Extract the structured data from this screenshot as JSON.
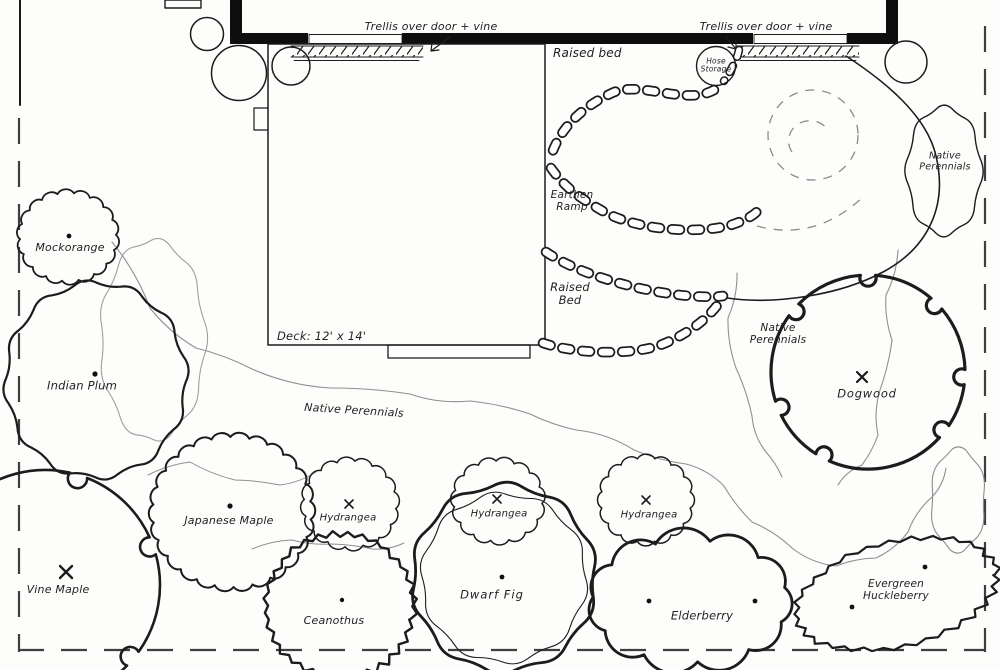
{
  "labels": {
    "trellis_left": "Trellis over door + vine",
    "trellis_right": "Trellis over door + vine",
    "raised_bed_upper": "Raised bed",
    "earthen_ramp": "Earthen Ramp",
    "raised_bed_lower": "Raised Bed",
    "hose_storage": "Hose Storage",
    "deck": "Deck: 12' x 14'",
    "native_perennials_top_right": "Native Perennials",
    "native_perennials_center": "Native Perennials",
    "native_perennials_band": "Native Perennials"
  },
  "plants": {
    "mockorange": "Mockorange",
    "indian_plum": "Indian Plum",
    "vine_maple": "Vine Maple",
    "japanese_maple": "Japanese Maple",
    "hydrangea_left": "Hydrangea",
    "hydrangea_center": "Hydrangea",
    "hydrangea_right": "Hydrangea",
    "ceanothus": "Ceanothus",
    "dwarf_fig": "Dwarf Fig",
    "elderberry": "Elderberry",
    "evergreen_huckleberry": "Evergreen Huckleberry",
    "dogwood": "Dogwood"
  }
}
